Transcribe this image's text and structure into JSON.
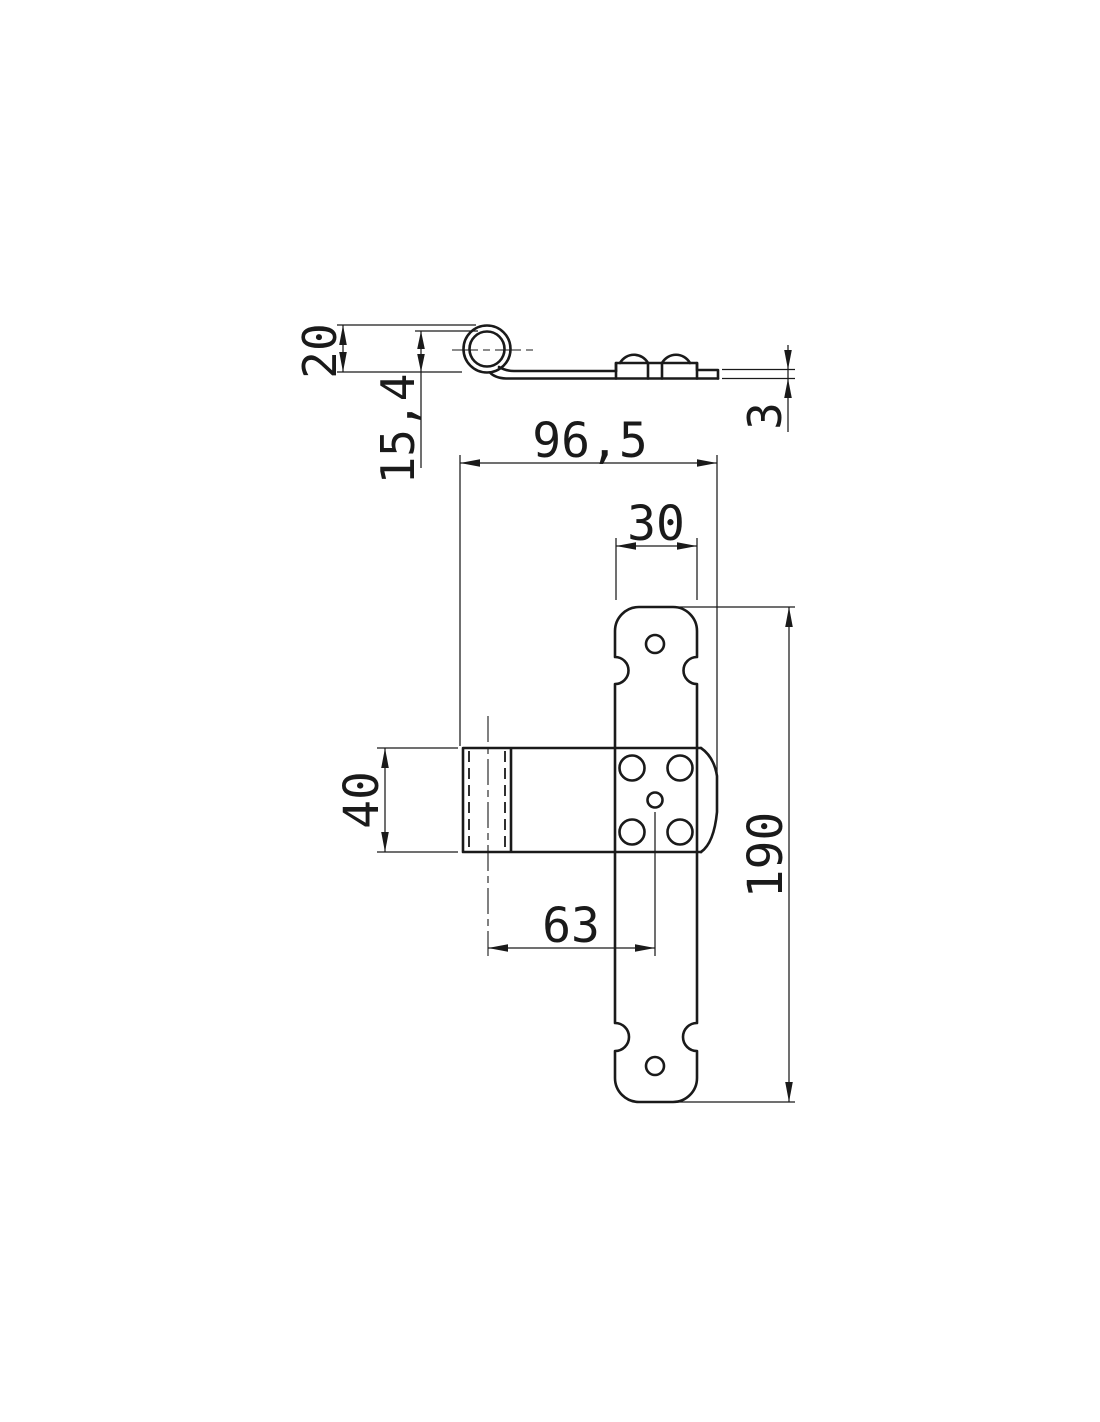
{
  "document": {
    "background": "#ffffff",
    "line_color": "#1a1a1a",
    "kind": "technical-drawing-t-hinge"
  },
  "dimensions": {
    "barrel_height": "20",
    "pin_offset": "15,4",
    "material_thickness": "3",
    "flap_length": "96,5",
    "strap_width": "30",
    "flap_width": "40",
    "pin_to_center_hole": "63",
    "strap_length": "190"
  }
}
